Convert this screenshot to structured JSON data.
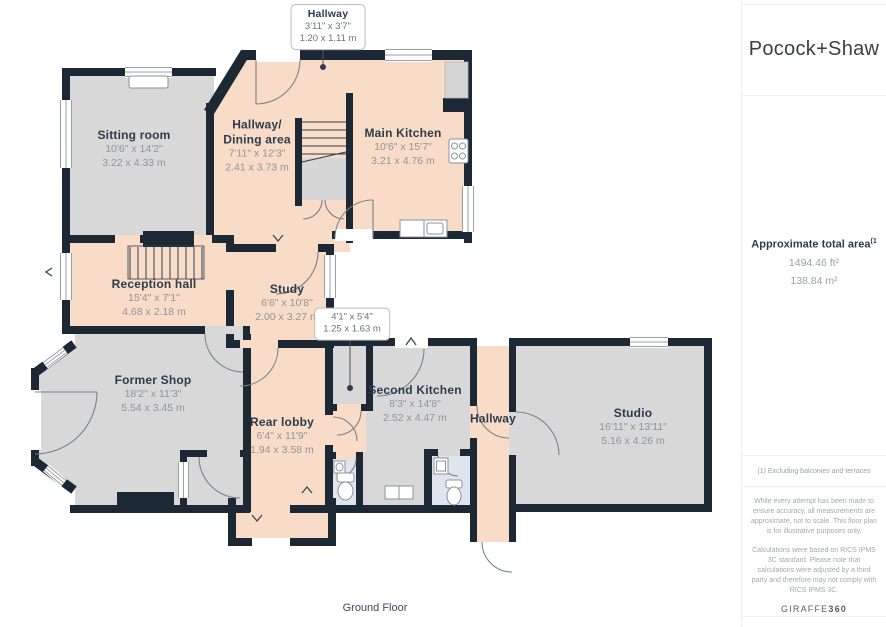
{
  "brand": {
    "name": "Pocock+Shaw"
  },
  "floor_label": "Ground Floor",
  "sidebar": {
    "area": {
      "title": "Approximate total area",
      "footnote_marker": "(1",
      "sqft": "1494.46 ft²",
      "sqm": "138.84 m²"
    },
    "footnote": "(1) Excluding balconies and terraces",
    "disclaimer1": "While every attempt has been made to ensure accuracy, all measurements are approximate, not to scale. This floor plan is for illustrative purposes only.",
    "disclaimer2": "Calculations were based on RICS IPMS 3C standard. Please note that calculations were adjusted by a third party and therefore may not comply with RICS IPMS 3C.",
    "credit_name": "GIRAFFE",
    "credit_suffix": "360"
  },
  "rooms": [
    {
      "id": "sitting-room",
      "name": "Sitting room",
      "imperial": "10'6\" x 14'2\"",
      "metric": "3.22 x 4.33 m"
    },
    {
      "id": "hallway-dining",
      "name": "Hallway/",
      "name2": "Dining area",
      "imperial": "7'11\" x 12'3\"",
      "metric": "2.41 x 3.73 m"
    },
    {
      "id": "main-kitchen",
      "name": "Main Kitchen",
      "imperial": "10'6\" x 15'7\"",
      "metric": "3.21 x 4.76 m"
    },
    {
      "id": "reception-hall",
      "name": "Reception hall",
      "imperial": "15'4\" x 7'1\"",
      "metric": "4.68 x 2.18 m"
    },
    {
      "id": "study",
      "name": "Study",
      "imperial": "6'6\" x 10'8\"",
      "metric": "2.00 x 3.27 m"
    },
    {
      "id": "former-shop",
      "name": "Former Shop",
      "imperial": "18'2\" x 11'3\"",
      "metric": "5.54 x 3.45 m"
    },
    {
      "id": "rear-lobby",
      "name": "Rear lobby",
      "imperial": "6'4\" x 11'9\"",
      "metric": "1.94 x 3.58 m"
    },
    {
      "id": "second-kitchen",
      "name": "Second Kitchen",
      "imperial": "8'3\" x 14'8\"",
      "metric": "2.52 x 4.47 m"
    },
    {
      "id": "hallway-small",
      "name": "Hallway"
    },
    {
      "id": "studio",
      "name": "Studio",
      "imperial": "16'11\" x 13'11\"",
      "metric": "5.16 x 4.26 m"
    }
  ],
  "callouts": [
    {
      "name": "Hallway",
      "imperial": "3'11\" x 3'7\"",
      "metric": "1.20 x 1.11 m"
    },
    {
      "imperial": "4'1\" x 5'4\"",
      "metric": "1.25 x 1.63 m"
    }
  ],
  "colors": {
    "wall": "#1c2935",
    "floor_peach": "#f8dcc7",
    "floor_gray": "#d8d8d8",
    "floor_blue": "#dfe5ef",
    "room_name_text": "#2d3c4e",
    "dimension_text": "#8f959d"
  }
}
